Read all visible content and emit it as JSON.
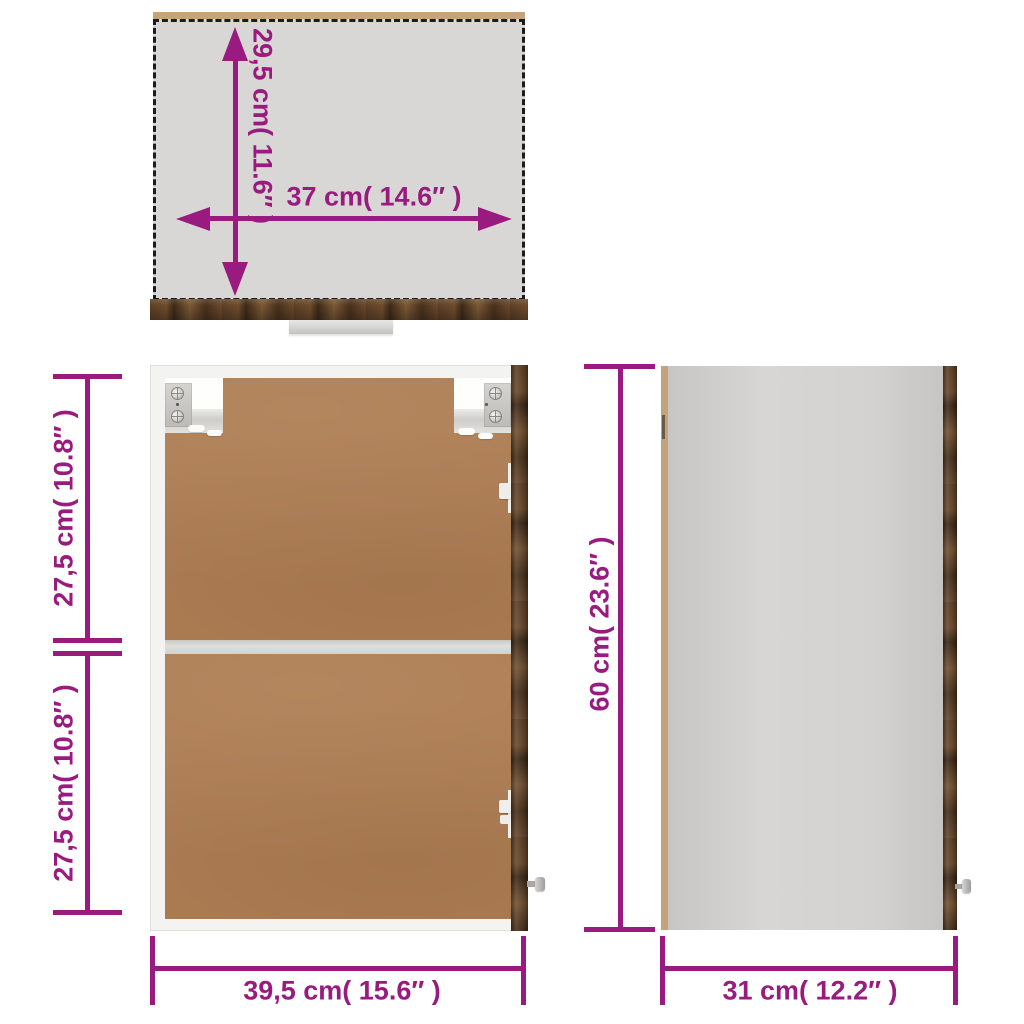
{
  "diagram_title": "wall cabinet dimension diagram",
  "dimensions": {
    "top_depth": "29,5 cm( 11.6″ )",
    "top_width": "37 cm( 14.6″ )",
    "front_upper_height": "27,5 cm( 10.8″ )",
    "front_lower_height": "27,5 cm( 10.8″ )",
    "front_width": "39,5 cm( 15.6″ )",
    "side_height": "60 cm( 23.6″ )",
    "side_depth": "31 cm( 12.2″ )"
  },
  "colors": {
    "dimension_accent": "#991B7F",
    "outline_black": "#1C1C1C",
    "top_panel_gray": "#D8D7D5",
    "side_panel_gray": "#D3D2D0",
    "frame_white": "#F3F3F1",
    "back_panel_brown": "#AE7D53",
    "wood_dark_brown": "#5C3F26",
    "edge_tan": "#C2A37B"
  }
}
